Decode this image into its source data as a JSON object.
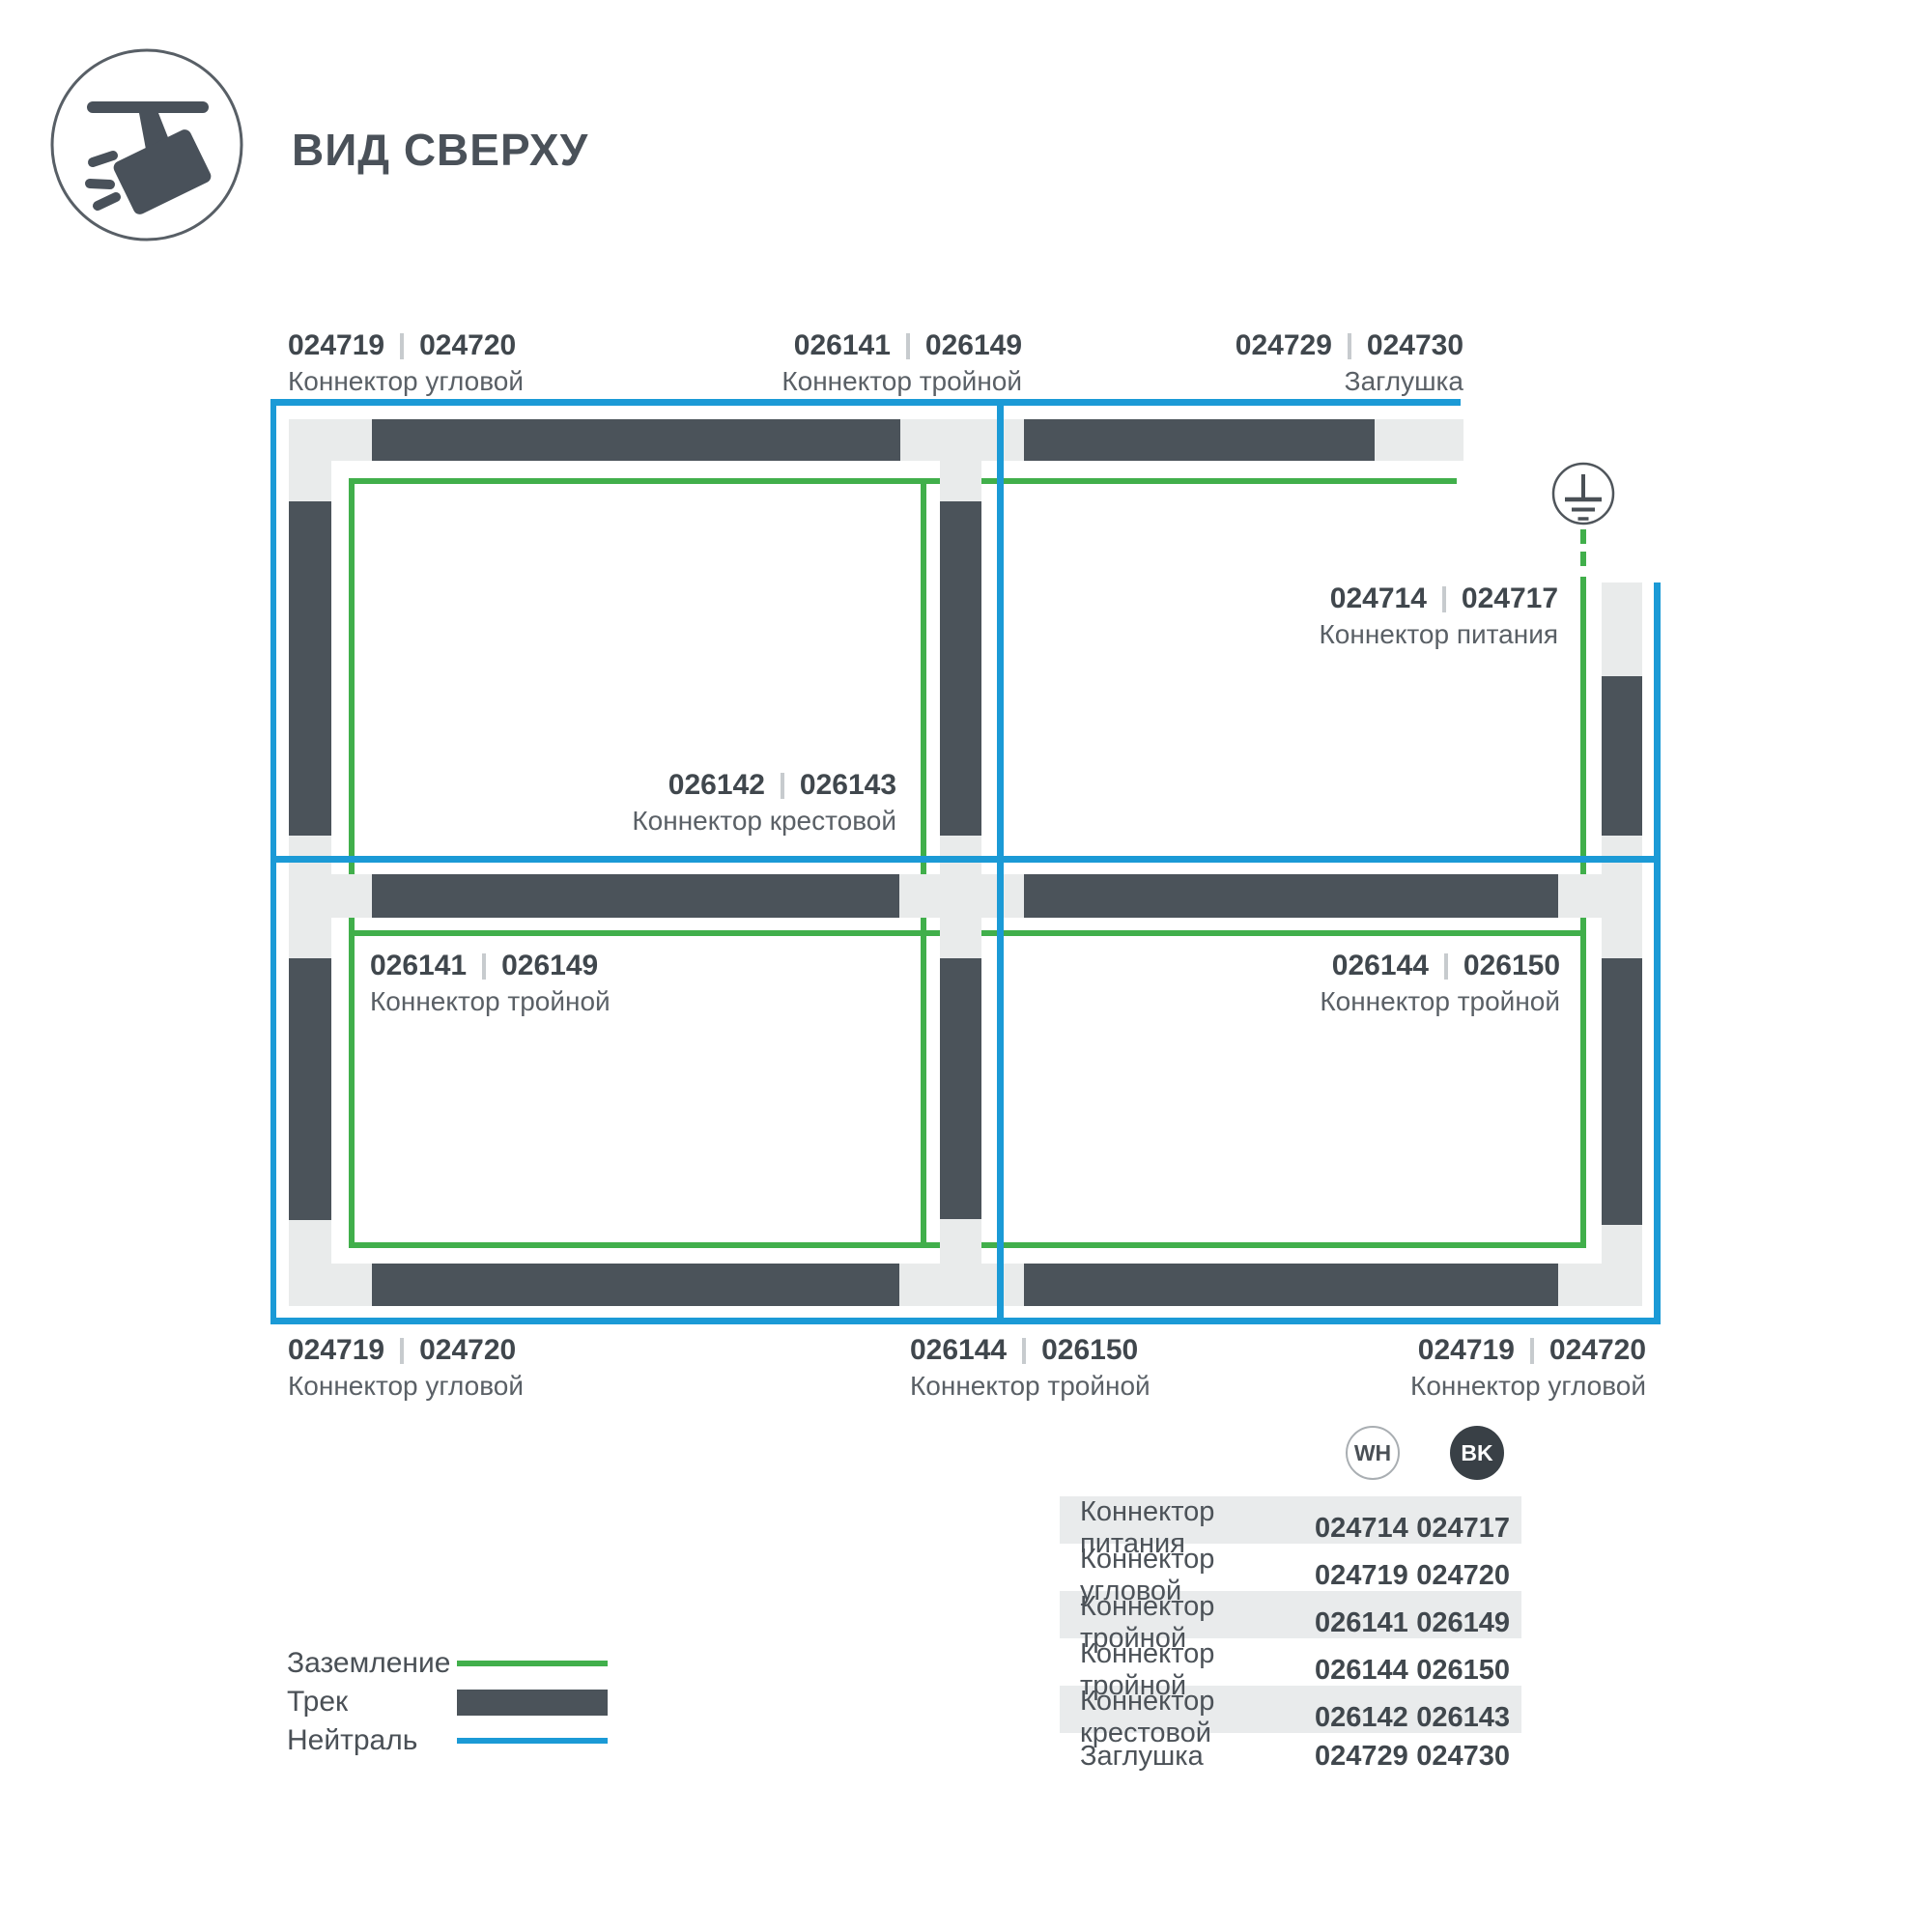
{
  "title": "ВИД СВЕРХУ",
  "colors": {
    "track": "#4b535a",
    "ground": "#41af4b",
    "neutral": "#1b9ad6",
    "pad": "#e9ebeb"
  },
  "labels": {
    "top_left": {
      "wh": "024719",
      "bk": "024720",
      "name": "Коннектор угловой"
    },
    "top_middle": {
      "wh": "026141",
      "bk": "026149",
      "name": "Коннектор тройной"
    },
    "top_right": {
      "wh": "024729",
      "bk": "024730",
      "name": "Заглушка"
    },
    "power": {
      "wh": "024714",
      "bk": "024717",
      "name": "Коннектор питания"
    },
    "cross": {
      "wh": "026142",
      "bk": "026143",
      "name": "Коннектор крестовой"
    },
    "room_c": {
      "wh": "026141",
      "bk": "026149",
      "name": "Коннектор тройной"
    },
    "room_d": {
      "wh": "026144",
      "bk": "026150",
      "name": "Коннектор тройной"
    },
    "bottom_left": {
      "wh": "024719",
      "bk": "024720",
      "name": "Коннектор угловой"
    },
    "bottom_middle": {
      "wh": "026144",
      "bk": "026150",
      "name": "Коннектор тройной"
    },
    "bottom_right": {
      "wh": "024719",
      "bk": "024720",
      "name": "Коннектор угловой"
    }
  },
  "legend": {
    "ground": "Заземление",
    "track": "Трек",
    "neutral": "Нейтраль"
  },
  "color_badges": {
    "wh": "WH",
    "bk": "BK"
  },
  "table": {
    "rows": [
      {
        "name": "Коннектор питания",
        "wh": "024714",
        "bk": "024717"
      },
      {
        "name": "Коннектор угловой",
        "wh": "024719",
        "bk": "024720"
      },
      {
        "name": "Коннектор тройной",
        "wh": "026141",
        "bk": "026149"
      },
      {
        "name": "Коннектор тройной",
        "wh": "026144",
        "bk": "026150"
      },
      {
        "name": "Коннектор крестовой",
        "wh": "026142",
        "bk": "026143"
      },
      {
        "name": "Заглушка",
        "wh": "024729",
        "bk": "024730"
      }
    ]
  }
}
